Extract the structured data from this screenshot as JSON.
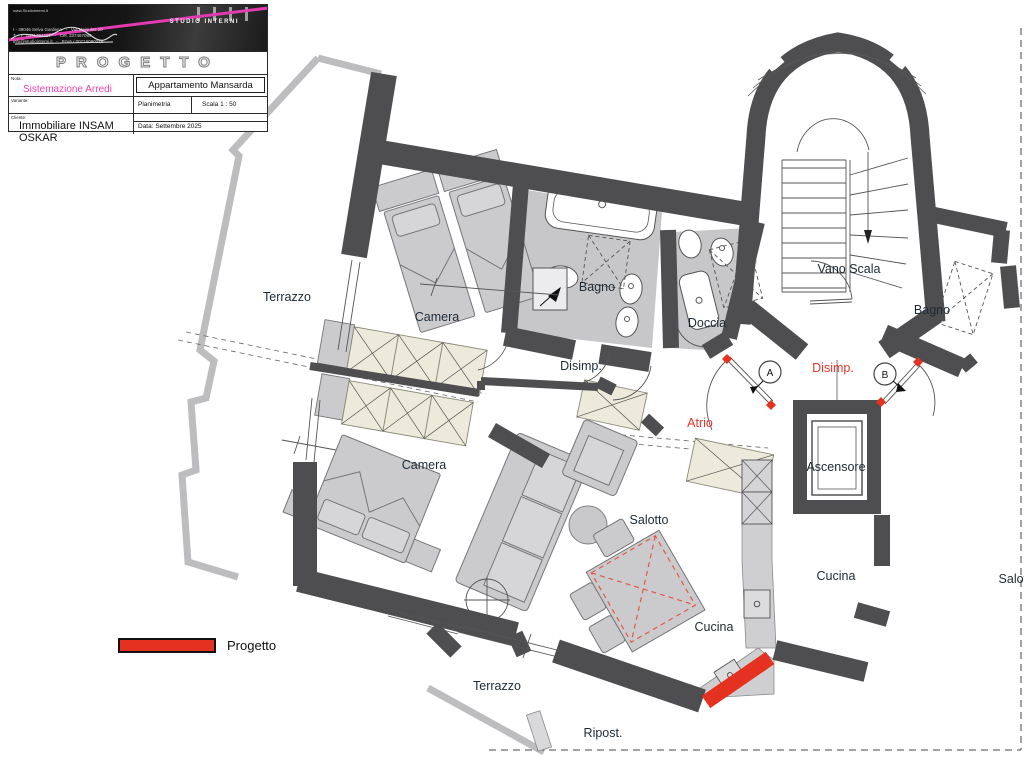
{
  "title_block": {
    "banner": {
      "studio_name": "STUDIO INTERNI",
      "website": "www.StudioInterni.it",
      "address": "I - 39046 Selva Gardena   -   Via Meisules 20\nT + F  0471794117   -   Cel. 337467099\ninfo@studiointerni.it   -   P.IVA / 00716090215"
    },
    "project_title": "PROGETTO",
    "nota_label": "Nota:",
    "nota_value": "Sistemazione Arredi",
    "apartment_box": "Appartamento Mansarda",
    "variante_label": "Variante:",
    "variante_value": "Planimetria",
    "scala_value": "Scala  1 : 50",
    "cliente_label": "Cliente:",
    "cliente_value": "Immobiliare INSAM OSKAR",
    "data_value": "Data: Settembre 2025"
  },
  "legend": {
    "label": "Progetto",
    "swatch_color": "#e5311f"
  },
  "plan": {
    "rooms": {
      "terrazzo_left": "Terrazzo",
      "camera_top": "Camera",
      "bagno_top": "Bagno",
      "doccia": "Doccia",
      "disimp_center": "Disimp.",
      "vano_scala": "Vano Scala",
      "bagno_right": "Bagno",
      "disimp_right": "Disimp.",
      "atrio": "Atrio",
      "ascensore": "Ascensore",
      "camera_bottom": "Camera",
      "salotto": "Salotto",
      "cucina_right": "Cucina",
      "salotto_right": "Salotto",
      "cucina_center": "Cucina",
      "terrazzo_bottom": "Terrazzo",
      "ripost": "Ripost.",
      "door_a": "A",
      "door_b": "B"
    },
    "colors": {
      "wall": "#4e4e50",
      "parapet": "#bdbdbf",
      "floor": "#c7c7c9",
      "furniture": "#cbcbcd",
      "wardrobe": "#edeadb",
      "red": "#e5311f",
      "label": "#1d2a36",
      "red_text": "#e8352a"
    }
  }
}
